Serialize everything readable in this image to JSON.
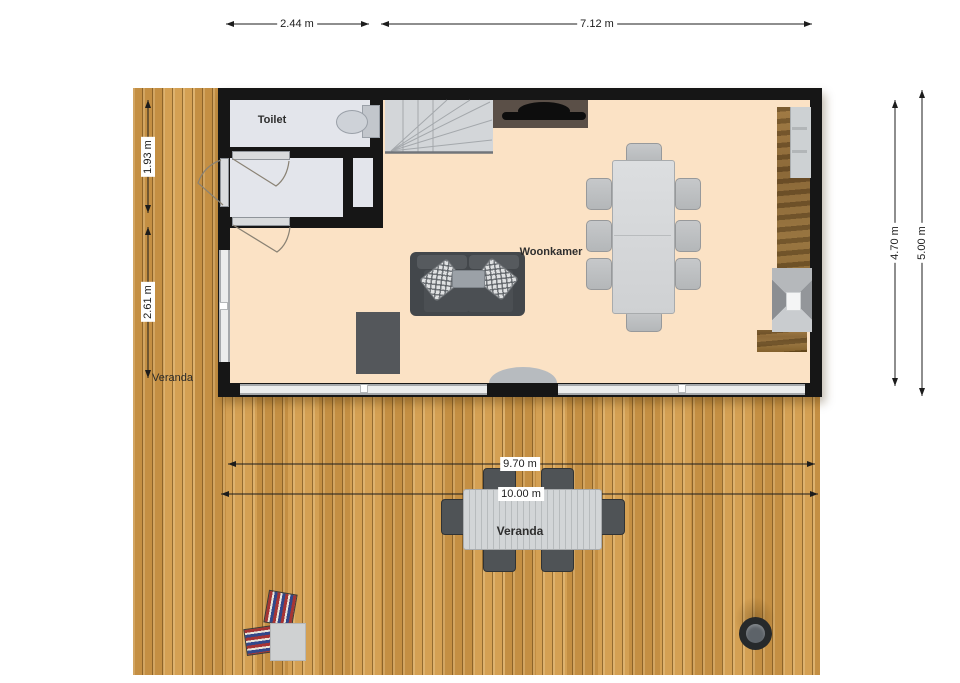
{
  "diagram_type": "floor-plan",
  "rooms": {
    "toilet": {
      "label": "Toilet"
    },
    "living": {
      "label": "Woonkamer"
    },
    "veranda_side": {
      "label": "Veranda"
    },
    "veranda_main": {
      "label": "Veranda"
    }
  },
  "dimensions": {
    "top_left_width": "2.44 m",
    "top_right_width": "7.12 m",
    "left_upper_height": "1.93 m",
    "left_lower_height": "2.61 m",
    "right_inner_height": "4.70 m",
    "right_outer_height": "5.00 m",
    "veranda_inner_width": "9.70 m",
    "veranda_outer_width": "10.00 m"
  },
  "furniture": [
    "staircase",
    "tv-console",
    "tv",
    "kitchen-counter",
    "kitchen-appliance",
    "stove-hood",
    "dining-table",
    "dining-chairs-x8",
    "sofa",
    "throw-pillows-x2",
    "coffee-tray",
    "rug",
    "doormat",
    "toilet-fixture",
    "outdoor-dining-table",
    "outdoor-chairs-x6",
    "deck-chairs-x2",
    "side-table",
    "fire-pit"
  ],
  "colors": {
    "wall": "#161616",
    "living_floor": "#fbe2c5",
    "wet_room_floor": "#e3e5eb",
    "deck_wood": "#cf9848",
    "counter_wood": "#86622f",
    "stairs": "#d3d6d9",
    "dimension_text": "#1c1c1c"
  }
}
